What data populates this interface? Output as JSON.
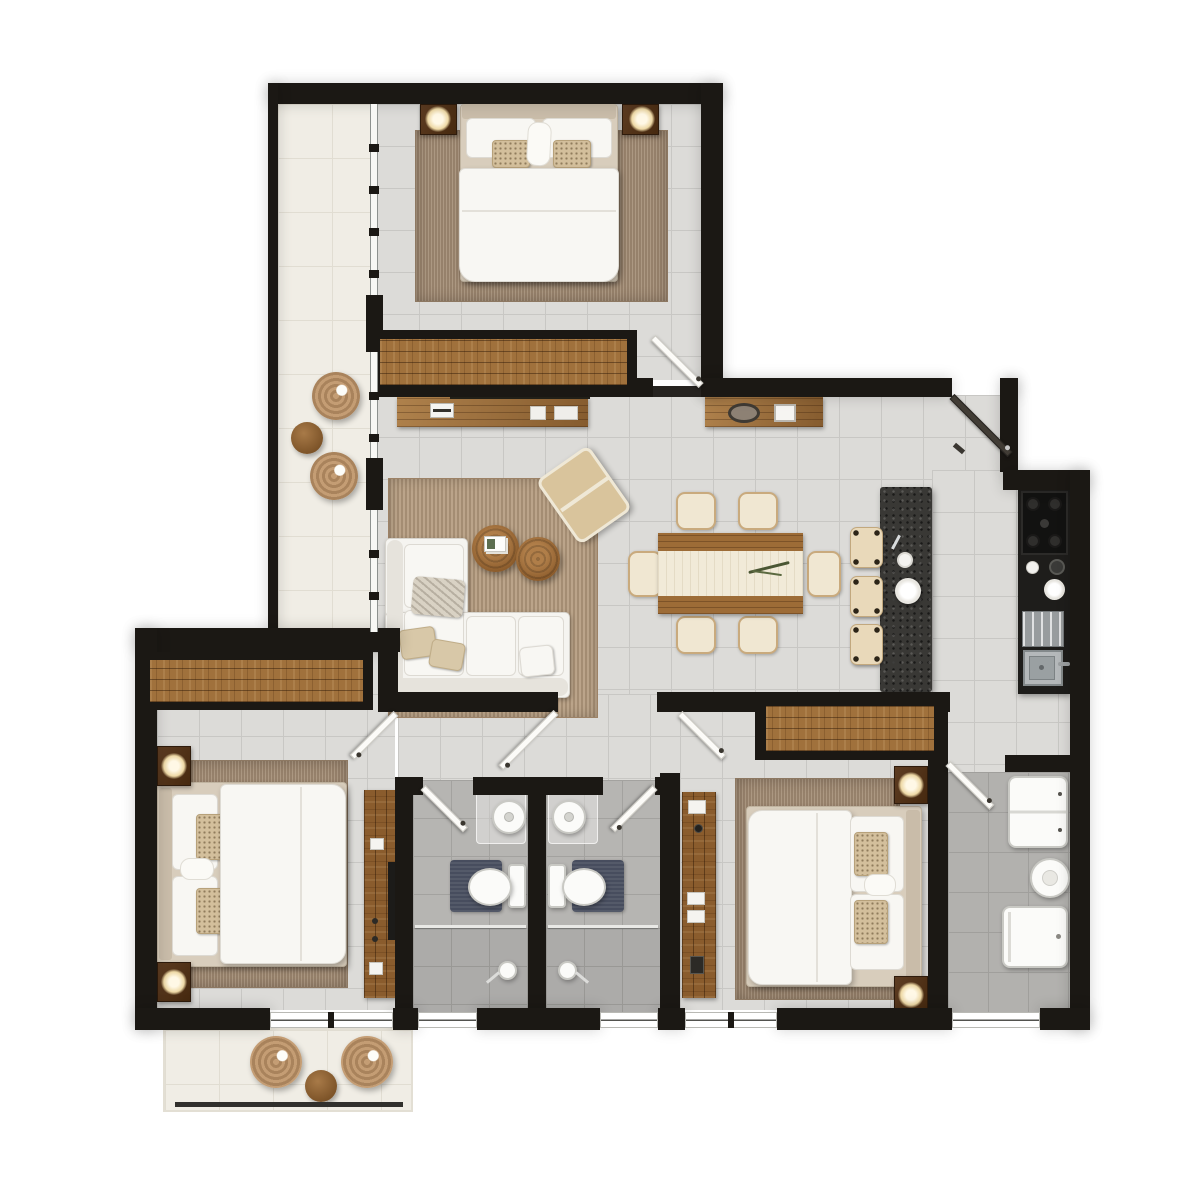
{
  "title": "apartment-floor-plan-render",
  "canvas": {
    "width": 1178,
    "height": 1178,
    "background": "#ffffff"
  },
  "palette": {
    "wall": "#1b1814",
    "tile_floor": "#dcdbd8",
    "tile_grid_line": "#c8c7c4",
    "bathroom_tile": "#b6b5b2",
    "shower_tile": "#acaba9",
    "utility_tile": "#b2b1ae",
    "balcony_floor": "#f0ede5",
    "oak_wood": "#9d6c37",
    "walnut_wood": "#5d3c22",
    "rug_taupe": "#a38c74",
    "rug_jute": "#b49b7e",
    "upholstery_white": "#f5f4f0",
    "bed_frame_beige": "#d8cdbc",
    "granite_island": "#393835",
    "counter_black": "#1e1d1b",
    "stool_cream": "#e9d9ba",
    "dining_chair_cream": "#f0e7d2",
    "rattan": "#c49d74",
    "bath_mat_navy": "#474d5e",
    "door_leaf_white": "#fcfbf8",
    "entry_door_dark": "#413c35",
    "lamp_glow": "#eed9a6",
    "glass": "#f8f8f5"
  },
  "rooms": [
    {
      "id": "bedroom-top",
      "type": "bedroom",
      "furniture": [
        "double-bed",
        "beige-bed-frame",
        "two-white-pillows",
        "two-patterned-pillows",
        "center-throw-ornament",
        "nightstand-with-lamp-left",
        "nightstand-with-lamp-right",
        "taupe-area-rug",
        "built-in-wardrobe",
        "media-console-with-laptop"
      ]
    },
    {
      "id": "living-room",
      "type": "living",
      "furniture": [
        "l-shaped-white-sofa",
        "beige-throw-pillows",
        "patterned-throw",
        "two-round-nesting-coffee-tables",
        "book-stack",
        "reclined-lounge-chair",
        "jute-rug"
      ]
    },
    {
      "id": "dining-area",
      "type": "dining",
      "furniture": [
        "wood-dining-table",
        "white-table-runner",
        "plant-sprig",
        "six-rattan-dining-chairs"
      ]
    },
    {
      "id": "kitchen",
      "type": "kitchen",
      "furniture": [
        "granite-island",
        "three-cream-bar-stools",
        "small-plate",
        "large-plate",
        "chef-knife",
        "gas-stove-four-burners",
        "coffee-cup",
        "grinder",
        "serving-plate",
        "dish-drainboard",
        "stainless-sink-with-faucet",
        "black-counter-run"
      ]
    },
    {
      "id": "entry-hall",
      "type": "entry",
      "furniture": [
        "console-table",
        "decor-bowl",
        "photo-frame",
        "dark-entrance-door"
      ]
    },
    {
      "id": "bedroom-left",
      "type": "bedroom",
      "furniture": [
        "double-bed",
        "headboard-left",
        "patterned-pillows",
        "taupe-area-rug",
        "built-in-wardrobe",
        "two-nightstands-with-lamps",
        "desk-with-tv"
      ]
    },
    {
      "id": "bedroom-right",
      "type": "bedroom",
      "furniture": [
        "double-bed",
        "headboard-right",
        "patterned-pillows",
        "taupe-area-rug",
        "built-in-wardrobe",
        "two-nightstands-with-lamps",
        "desk-with-accessories"
      ]
    },
    {
      "id": "bathroom-left",
      "type": "bathroom",
      "furniture": [
        "round-vessel-sink",
        "glass-vanity",
        "toilet",
        "navy-bath-mat",
        "walk-in-shower-with-glass-screen",
        "shower-head"
      ]
    },
    {
      "id": "bathroom-right",
      "type": "bathroom",
      "furniture": [
        "round-vessel-sink",
        "glass-vanity",
        "toilet",
        "navy-bath-mat",
        "walk-in-shower-with-glass-screen",
        "shower-head"
      ]
    },
    {
      "id": "utility-room",
      "type": "utility",
      "furniture": [
        "two-door-wall-cabinet",
        "round-basin",
        "washing-machine"
      ]
    },
    {
      "id": "balcony-left",
      "type": "balcony",
      "furniture": [
        "rattan-pouf",
        "rattan-pouf",
        "round-side-table"
      ]
    },
    {
      "id": "balcony-bottom",
      "type": "balcony",
      "furniture": [
        "rattan-pouf",
        "rattan-pouf",
        "round-side-table",
        "railing"
      ]
    }
  ],
  "doors": [
    {
      "room": "bedroom-top",
      "style": "white-swing"
    },
    {
      "room": "entry-hall",
      "style": "dark-swing"
    },
    {
      "room": "hallway",
      "style": "white-swing"
    },
    {
      "room": "bedroom-left",
      "style": "white-swing"
    },
    {
      "room": "bedroom-right",
      "style": "white-swing"
    },
    {
      "room": "bathroom-left",
      "style": "white-swing"
    },
    {
      "room": "bathroom-right",
      "style": "white-swing"
    },
    {
      "room": "utility-room",
      "style": "white-swing"
    }
  ],
  "windows": [
    {
      "location": "balcony-left-glass-wall",
      "style": "full-height-glazing-with-mullions"
    },
    {
      "location": "bedroom-left-to-balcony",
      "style": "sliding-glass-door"
    },
    {
      "location": "bathroom-left-bottom",
      "style": "window"
    },
    {
      "location": "bathroom-right-bottom",
      "style": "window"
    },
    {
      "location": "bedroom-right-bottom",
      "style": "window"
    },
    {
      "location": "utility-bottom",
      "style": "window"
    }
  ]
}
